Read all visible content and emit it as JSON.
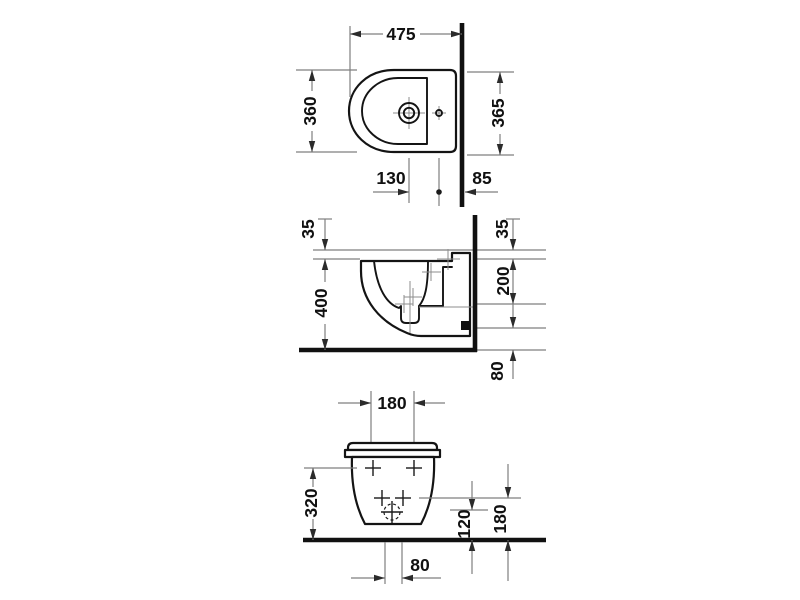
{
  "page": {
    "background": "#ffffff"
  },
  "colors": {
    "outline": "#141414",
    "wall_floor": "#111111",
    "dimension_lines": "#7f7f7f",
    "text": "#111111"
  },
  "views": {
    "top": {
      "dims": {
        "depth_to_wall": "475",
        "width_left": "360",
        "width_right": "365",
        "tap_offset": "130",
        "hole_to_wall": "85"
      }
    },
    "side": {
      "dims": {
        "ledge_left": "35",
        "rim_height": "400",
        "ledge_right": "35",
        "mid_height": "200",
        "floor_clearance": "80"
      }
    },
    "front": {
      "dims": {
        "top_spacing": "180",
        "fixing_height": "320",
        "drain_height": "120",
        "holes_height": "180",
        "outlet_width": "80"
      }
    }
  }
}
